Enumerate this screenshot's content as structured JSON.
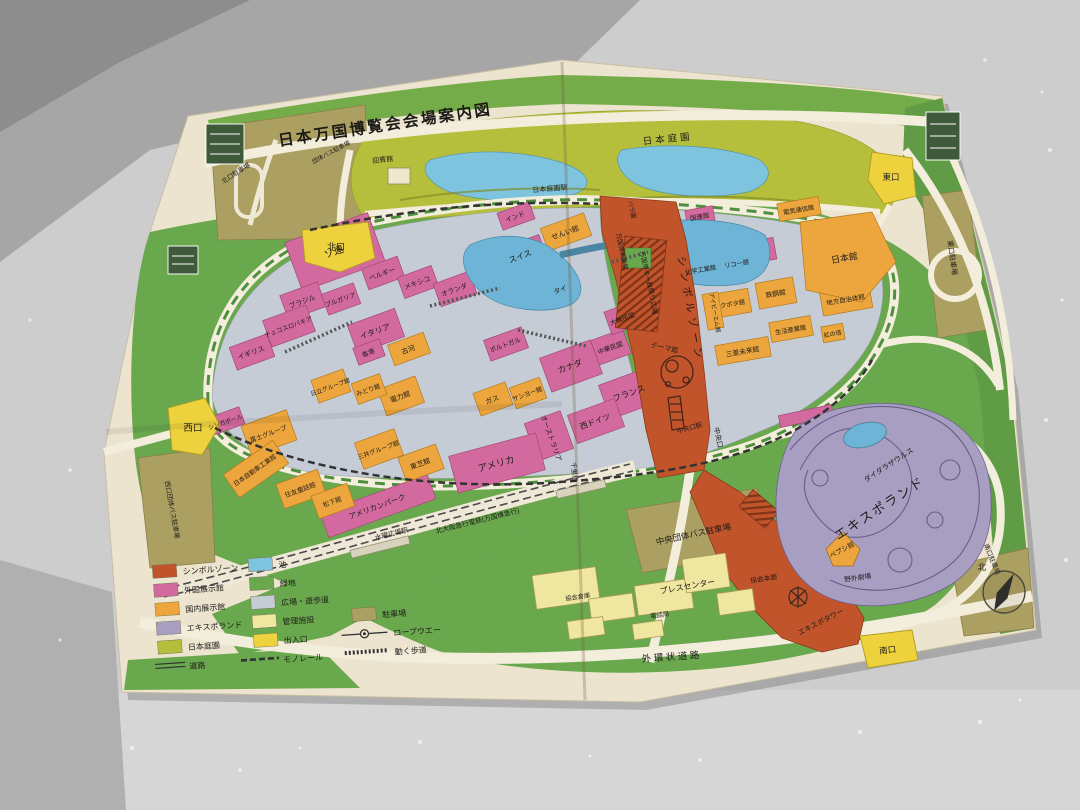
{
  "map": {
    "title": "日本万国博覧会会場案内図",
    "legend": {
      "items": [
        {
          "label": "シンボルゾーン",
          "color": "#c2542c"
        },
        {
          "label": "外国展示館",
          "color": "#d36a9f"
        },
        {
          "label": "国内展示館",
          "color": "#eca63d"
        },
        {
          "label": "エキスポランド",
          "color": "#a89ec2"
        },
        {
          "label": "日本庭園",
          "color": "#b5bf3b"
        },
        {
          "label": "池",
          "color": "#7ec4de"
        },
        {
          "label": "緑地",
          "color": "#6aa84e"
        },
        {
          "label": "広場・遊歩道",
          "color": "#c6ccd6"
        },
        {
          "label": "管理施設",
          "color": "#efe6a0"
        },
        {
          "label": "駐車場",
          "color": "#ac9f62"
        },
        {
          "label": "出入口",
          "color": "#edd23e"
        },
        {
          "label": "ロープウエー"
        },
        {
          "label": "道路"
        },
        {
          "label": "モノレール"
        },
        {
          "label": "動く歩道"
        }
      ]
    },
    "labels": {
      "west_gate": "西口",
      "north_gate": "北口",
      "east_gate": "東口",
      "south_gate": "南口",
      "central_gate": "中央口",
      "central_gate_station": "中央口駅",
      "japanese_garden": "日本庭園",
      "japanese_garden_station": "日本庭園駅",
      "geihinkan": "迎賓館",
      "west_bus_parking": "西口団体バス駐車場",
      "north_parking": "北口駐車場",
      "group_bus_parking": "団体バス駐車場",
      "east_parking": "東口駐車場",
      "south_parking": "南口駐車場",
      "central_bus_parking": "中央団体バス駐車場",
      "suiyo_plaza_station": "水曜広場駅",
      "kita_osaka_express": "北大阪急行電鉄(万国博急行)",
      "outer_ring_road": "外環状道路",
      "senri_bridge": "千里橋",
      "symbol_zone": "シンボルゾーン",
      "expo_museum": "万国博美術館",
      "expo_hall": "万国博ホール",
      "rose_garden": "バラ園",
      "festival_plaza": "お祭り広場",
      "theme_pavilion": "テーマ館",
      "expo_tower": "エキスポタワー",
      "un_pavilion": "国連館",
      "soviet": "ソ連",
      "belgium": "ベルギー",
      "mexico": "メキシコ",
      "netherlands": "オランダ",
      "brazil": "ブラジル",
      "bulgaria": "ブルガリア",
      "czechoslovakia": "チェコスロバキア",
      "italy": "イタリア",
      "uk": "イギリス",
      "hongkong": "香港",
      "switzerland": "スイス",
      "india": "インド",
      "thailand": "タイ",
      "portugal": "ポルトガル",
      "canada": "カナダ",
      "france": "フランス",
      "west_germany": "西ドイツ",
      "australia": "オーストラリア",
      "usa": "アメリカ",
      "roc": "中華民国",
      "korea": "大韓民国",
      "american_park": "アメリカンパーク",
      "singapore": "シンガポール",
      "textile": "せんい館",
      "furukawa": "古河",
      "power": "電力館",
      "gas": "ガス",
      "sanyo": "サンヨー館",
      "toshiba": "東芝館",
      "midori": "みどり館",
      "hitachi": "日立グループ館",
      "fuji_group": "富士グループ",
      "mitsui": "三井グループ館",
      "sumitomo": "住友童話館",
      "matsushita": "松下館",
      "auto_industry": "日本自動車工業館",
      "chemical": "化学工業館",
      "ricoh": "リコー館",
      "kubota": "クボタ館",
      "ibm": "アイビーエム館",
      "steel": "鉄鋼館",
      "life_industry": "生活産業館",
      "mitsubishi": "三菱未来館",
      "rainbow_tower": "虹の塔",
      "telecom": "電気通信館",
      "japan_pavilion": "日本館",
      "local_gov": "地方自治体館",
      "pepsi": "ペプシ館",
      "expoland": "エキスポランド",
      "daidarasaurus": "ダイダラザウルス",
      "outdoor_theater": "野外劇場",
      "press_center": "プレスセンター",
      "assoc_hq": "協会本部",
      "assoc_warehouse": "協会倉庫",
      "telephone": "電話局",
      "compass_north": "北"
    }
  }
}
